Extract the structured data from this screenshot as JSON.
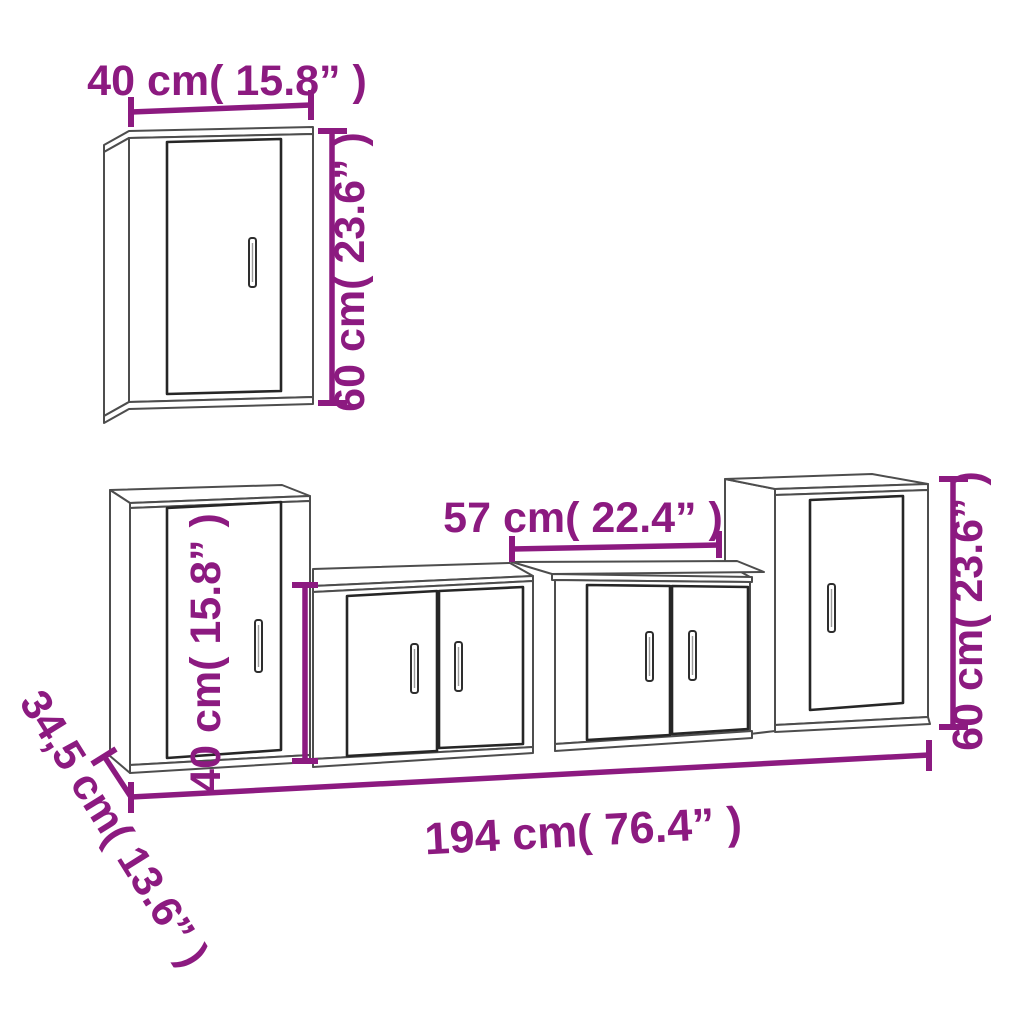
{
  "page": {
    "background": "#ffffff"
  },
  "colors": {
    "accent": "#8C1A80",
    "line": "#4d4d4d",
    "door_line": "#262626"
  },
  "dimensions": {
    "wall_cabinet_width": "40 cm( 15.8” )",
    "wall_cabinet_height": "60 cm( 23.6” )",
    "low_cabinet_width": "57 cm( 22.4” )",
    "low_cabinet_height": "40 cm( 15.8” )",
    "right_cabinet_height": "60 cm( 23.6” )",
    "total_width": "194 cm( 76.4” )",
    "depth": "34,5 cm( 13.6” )"
  }
}
